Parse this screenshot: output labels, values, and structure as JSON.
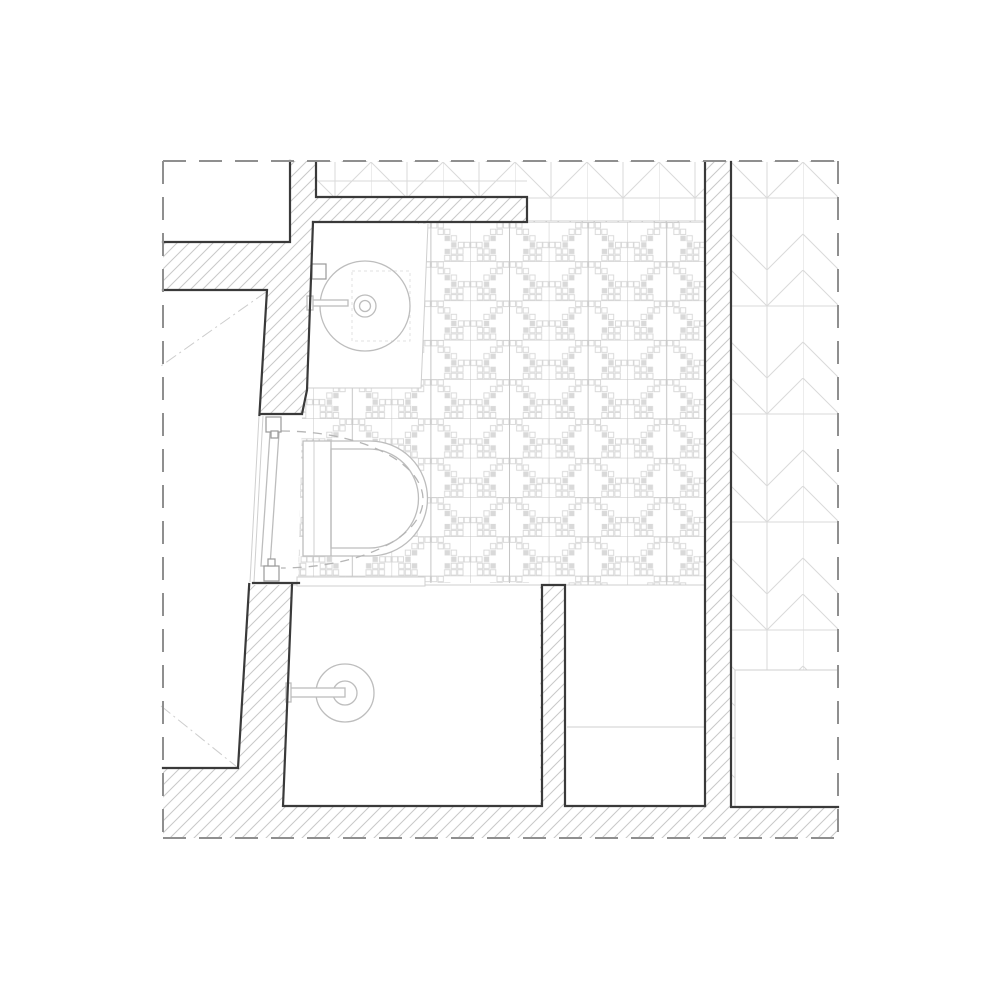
{
  "drawing": {
    "kind": "bathroom-floor-plan",
    "visible_text": [],
    "legend": {
      "boundary": "dashed property/extent line",
      "walls": "diagonal-hatched masonry walls",
      "tile-floor": "pixel-mosaic patterned bathroom floor",
      "herringbone-floor": "chevron parquet floor of adjacent room",
      "fixtures": [
        "washbasin-counter",
        "round-basin",
        "faucet",
        "wall-hung-toilet",
        "door-leaf",
        "door-swing-arc",
        "shower-drain"
      ]
    }
  },
  "colors": {
    "bg": "#ffffff",
    "wall-line": "#3a3a3a",
    "boundary-line": "#8f8f8f",
    "hatch-line": "#c9c9c9",
    "fixture-line": "#bdbdbd",
    "light-line": "#cfcfcf",
    "grid-line": "#c6c6c6",
    "motif-line": "#d7d7d7",
    "motif-fill": "#d9d9d9",
    "herr-line": "#dadada",
    "med-line": "#9a9a9a",
    "arc-dash": "#b5b5b5",
    "centerline": "#cdcdcd",
    "faint-line": "#e2e2e2"
  }
}
